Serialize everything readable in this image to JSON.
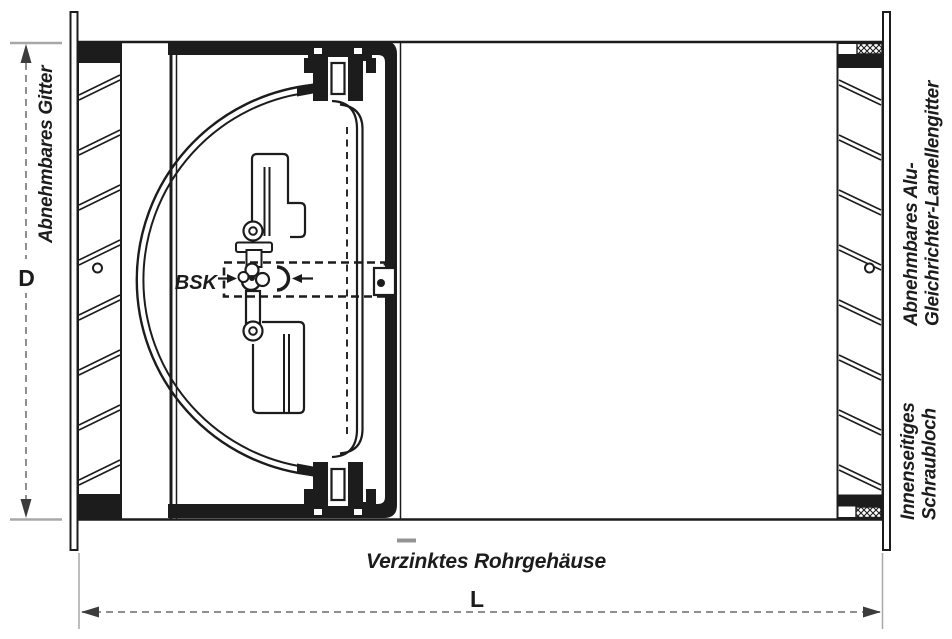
{
  "drawing": {
    "left_label": "Abnehmbares Gitter",
    "right_label_top": [
      "Abnehmbares Alu-",
      "Gleichrichter-Lamellengitter"
    ],
    "right_label_bottom": [
      "Innenseitiges",
      "Schraubloch"
    ],
    "bottom_label": "Verzinktes Rohrgehäuse",
    "fuse_label": "BSK",
    "dim_height_label": "D",
    "dim_length_label": "L",
    "colors": {
      "line": "#1c1c1c",
      "dimension_line": "#8f8f8f",
      "tick": "#a8a8a8",
      "arrowhead": "#3c3c3c",
      "background": "#ffffff"
    }
  }
}
